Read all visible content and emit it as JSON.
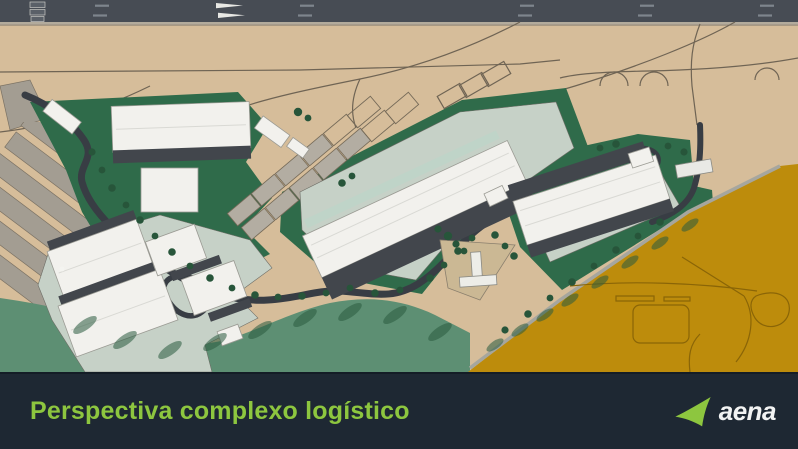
{
  "footer": {
    "title": "Perspectiva complexo logístico",
    "brand": "aena"
  },
  "map": {
    "name": "logistics-complex-site-plan",
    "description": "Aerial rendering of an airport logistics complex: white warehouse buildings on green plots, winding access roads with trees, highway strip at top, tan airfield ground and an orange development parcel at lower right"
  },
  "colors": {
    "footer_bg": "#1e2833",
    "accent": "#8dc63f",
    "brand_white": "#f2f3f3",
    "ground_tan": "#d6bd9a",
    "road_strip": "#474c54",
    "road_dark": "#383d44",
    "green_dark": "#2f6b4a",
    "green_light": "#5d8f73",
    "pavement": "#c6d1c7",
    "building_white": "#f2f1ed",
    "roof_dark": "#42464c",
    "parcel_orange": "#bd8c0c",
    "line_tan": "#6f6454",
    "gray_structure": "#a39d92",
    "mint": "#bfd4c8",
    "tree_green": "#27553a"
  }
}
